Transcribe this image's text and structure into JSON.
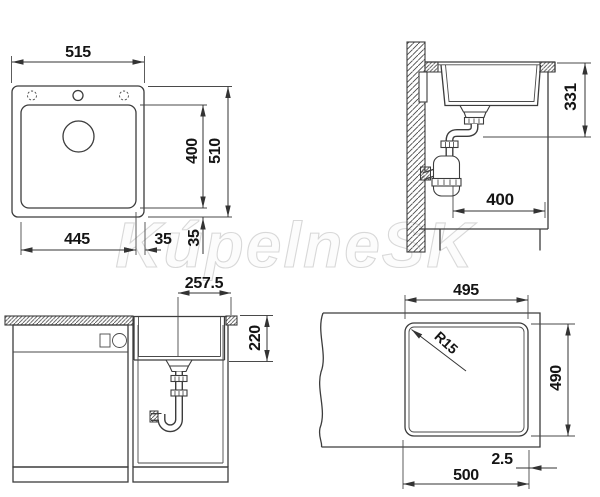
{
  "watermark": "KúpelneSK",
  "views": {
    "plan": {
      "overall_width": "515",
      "overall_depth": "510",
      "bowl_width": "445",
      "bowl_depth": "400",
      "rim_side": "35",
      "rim_front": "35"
    },
    "section": {
      "drain_height": "331",
      "clearance_depth": "400"
    },
    "front": {
      "drain_offset": "257.5",
      "bowl_height": "220"
    },
    "cutout": {
      "width": "495",
      "depth": "490",
      "corner_radius": "R15",
      "edge_offset": "2.5",
      "min_width": "500"
    }
  }
}
